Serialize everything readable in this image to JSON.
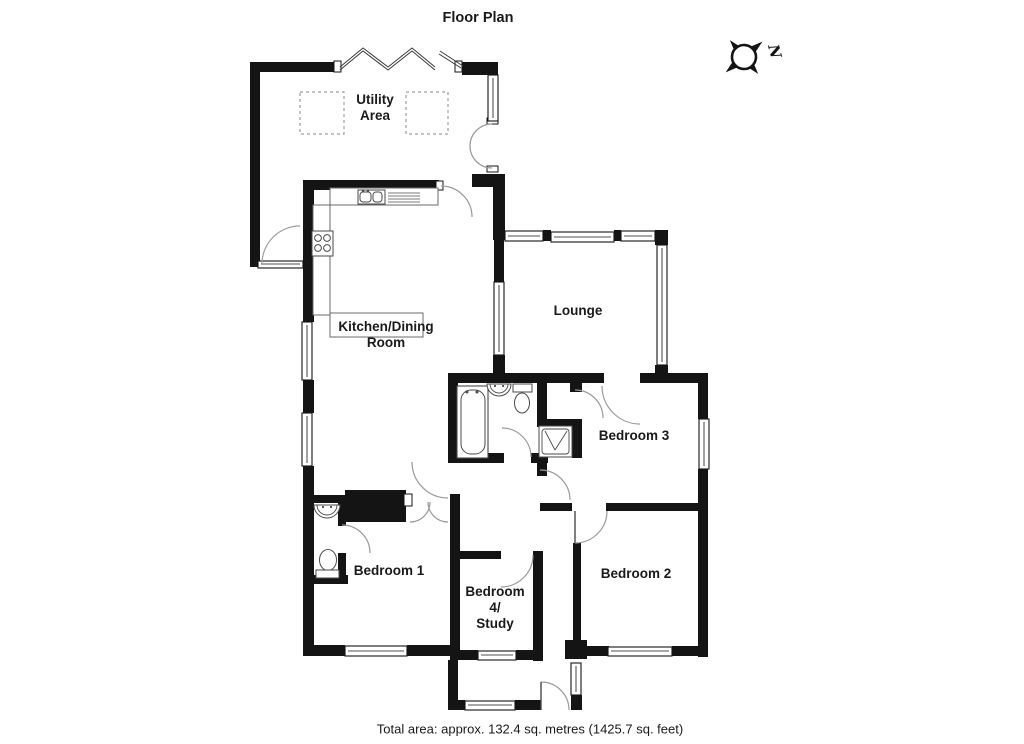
{
  "title": "Floor Plan",
  "compass": {
    "north_label": "N"
  },
  "rooms": [
    {
      "id": "utility-area",
      "lines": [
        "Utility",
        "Area"
      ]
    },
    {
      "id": "kitchen-dining-room",
      "lines": [
        "Kitchen/Dining",
        "Room"
      ]
    },
    {
      "id": "lounge",
      "lines": [
        "Lounge"
      ]
    },
    {
      "id": "bedroom-3",
      "lines": [
        "Bedroom 3"
      ]
    },
    {
      "id": "bedroom-1",
      "lines": [
        "Bedroom 1"
      ]
    },
    {
      "id": "bedroom-4-study",
      "lines": [
        "Bedroom",
        "4/",
        "Study"
      ]
    },
    {
      "id": "bedroom-2",
      "lines": [
        "Bedroom 2"
      ]
    }
  ],
  "footer": {
    "total_area": "Total area: approx. 132.4 sq. metres (1425.7 sq. feet)"
  },
  "colors": {
    "wall": "#141414",
    "fixture_line": "#4a4a4a",
    "door_arc": "#9a9a9a",
    "text": "#1a1a1a"
  }
}
